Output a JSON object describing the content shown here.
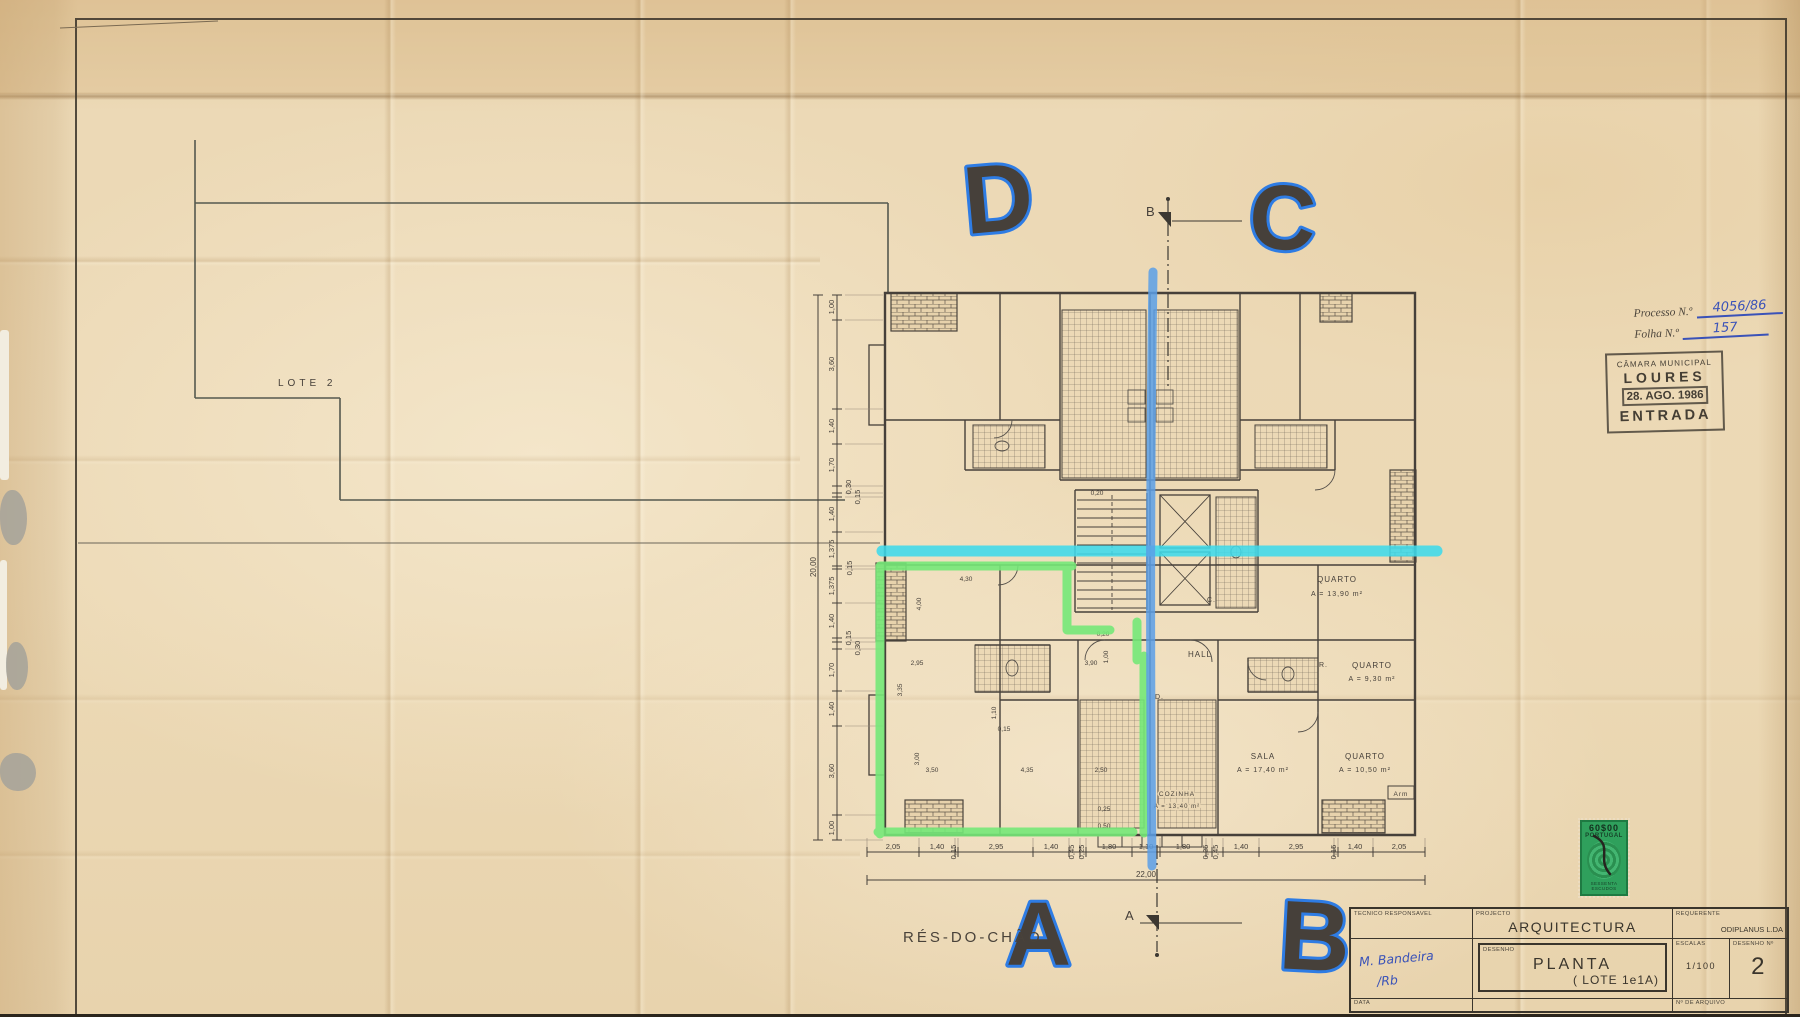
{
  "site": {
    "lote_label": "LOTE  2"
  },
  "floor_label": "RÉS-DO-CHÃO",
  "process_box": {
    "processo_label": "Processo N.º",
    "processo_value": "4056/86",
    "folha_label": "Folha N.º",
    "folha_value": "157"
  },
  "entry_stamp": {
    "municipality": "CÂMARA MUNICIPAL",
    "city": "LOURES",
    "date": "28. AGO. 1986",
    "word": "ENTRADA"
  },
  "fiscal_stamp": {
    "value": "60$00",
    "country": "PORTUGAL",
    "denomination": "SESSENTA ESCUDOS"
  },
  "title_block": {
    "tecnico_label": "TECNICO RESPONSAVEL",
    "signature_line1": "M. Bandeira",
    "signature_line2": "/Rb",
    "projecto_label": "PROJECTO",
    "projecto_value": "ARQUITECTURA",
    "requerente_label": "REQUERENTE",
    "requerente_value": "ODIPLANUS  L.DA",
    "desenho_label": "DESENHO",
    "desenho_value": "PLANTA",
    "desenho_detail": "( LOTE  1e1A)",
    "escalas_label": "ESCALAS",
    "escalas_value": "1/100",
    "numero_label": "DESENHO Nº",
    "numero_value": "2",
    "data_label": "DATA",
    "arquivo_label": "Nº DE ARQUIVO"
  },
  "annotations": {
    "letter_a": "A",
    "letter_b": "B",
    "letter_c": "C",
    "letter_d": "D"
  },
  "plan": {
    "section_top": "B",
    "section_bottom": "A",
    "rooms": [
      {
        "name": "QUARTO",
        "area": "A = 13,90 m²"
      },
      {
        "name": "QUARTO",
        "area": "A = 9,30 m²"
      },
      {
        "name": "SALA",
        "area": "A = 17,40 m²"
      },
      {
        "name": "QUARTO",
        "area": "A = 10,50 m²"
      },
      {
        "name": "COZINHA",
        "area": "A = 13,40 m²"
      },
      {
        "name": "HALL"
      }
    ],
    "small_labels": {
      "d": "D.",
      "c": "C.",
      "r": "R.",
      "arm": "Arm"
    },
    "dims_bottom": [
      "2,05",
      "1,40",
      "0,15",
      "2,95",
      "1,40",
      "0,45",
      "0,25",
      "1,80",
      "1,10",
      "1,80",
      "0,25",
      "0,45",
      "1,40",
      "2,95",
      "0,15",
      "1,40",
      "2,05"
    ],
    "dims_bottom_total": "22,00",
    "dims_left": [
      "1,00",
      "3,60",
      "1,40",
      "1,70",
      "0,30",
      "0,15",
      "1,40",
      "1,375",
      "0,15",
      "1,375",
      "1,40",
      "0,15",
      "0,30",
      "1,70",
      "1,40",
      "3,60",
      "1,00"
    ],
    "dims_left_total": "20,00",
    "dims_interior": [
      "4,30",
      "4,00",
      "2,95",
      "3,35",
      "3,90",
      "1,00",
      "3,50",
      "4,35",
      "2,50",
      "3,00",
      "1,10",
      "0,20",
      "0,20",
      "0,25",
      "0,50",
      "0,15"
    ]
  }
}
